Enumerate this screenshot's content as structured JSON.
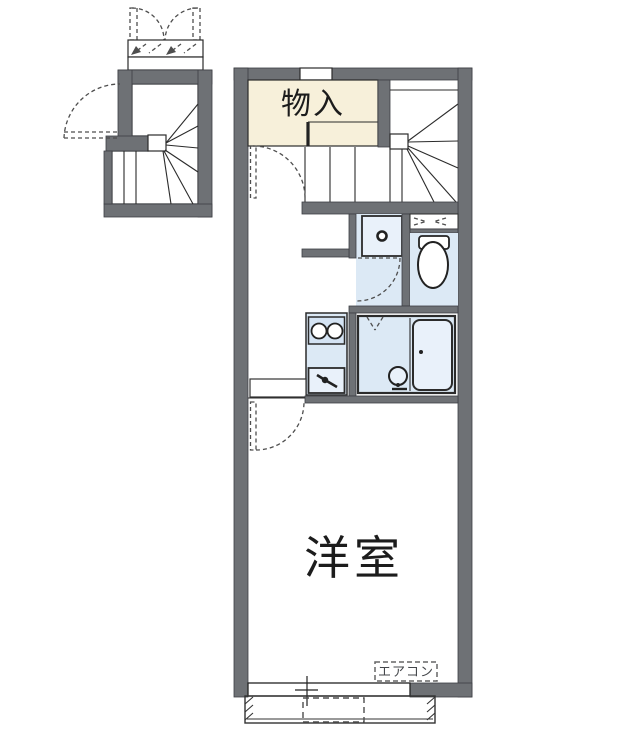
{
  "floorplan": {
    "labels": {
      "storage": "物入",
      "western_room": "洋室",
      "aircon": "エアコン"
    },
    "colors": {
      "wall": "#6e7175",
      "line": "#2b2b2b",
      "dash": "#4e4e4e",
      "room_blue": "#dce9f5",
      "fixture_blue": "#e9f1fa",
      "cream": "#f7f0da"
    }
  }
}
